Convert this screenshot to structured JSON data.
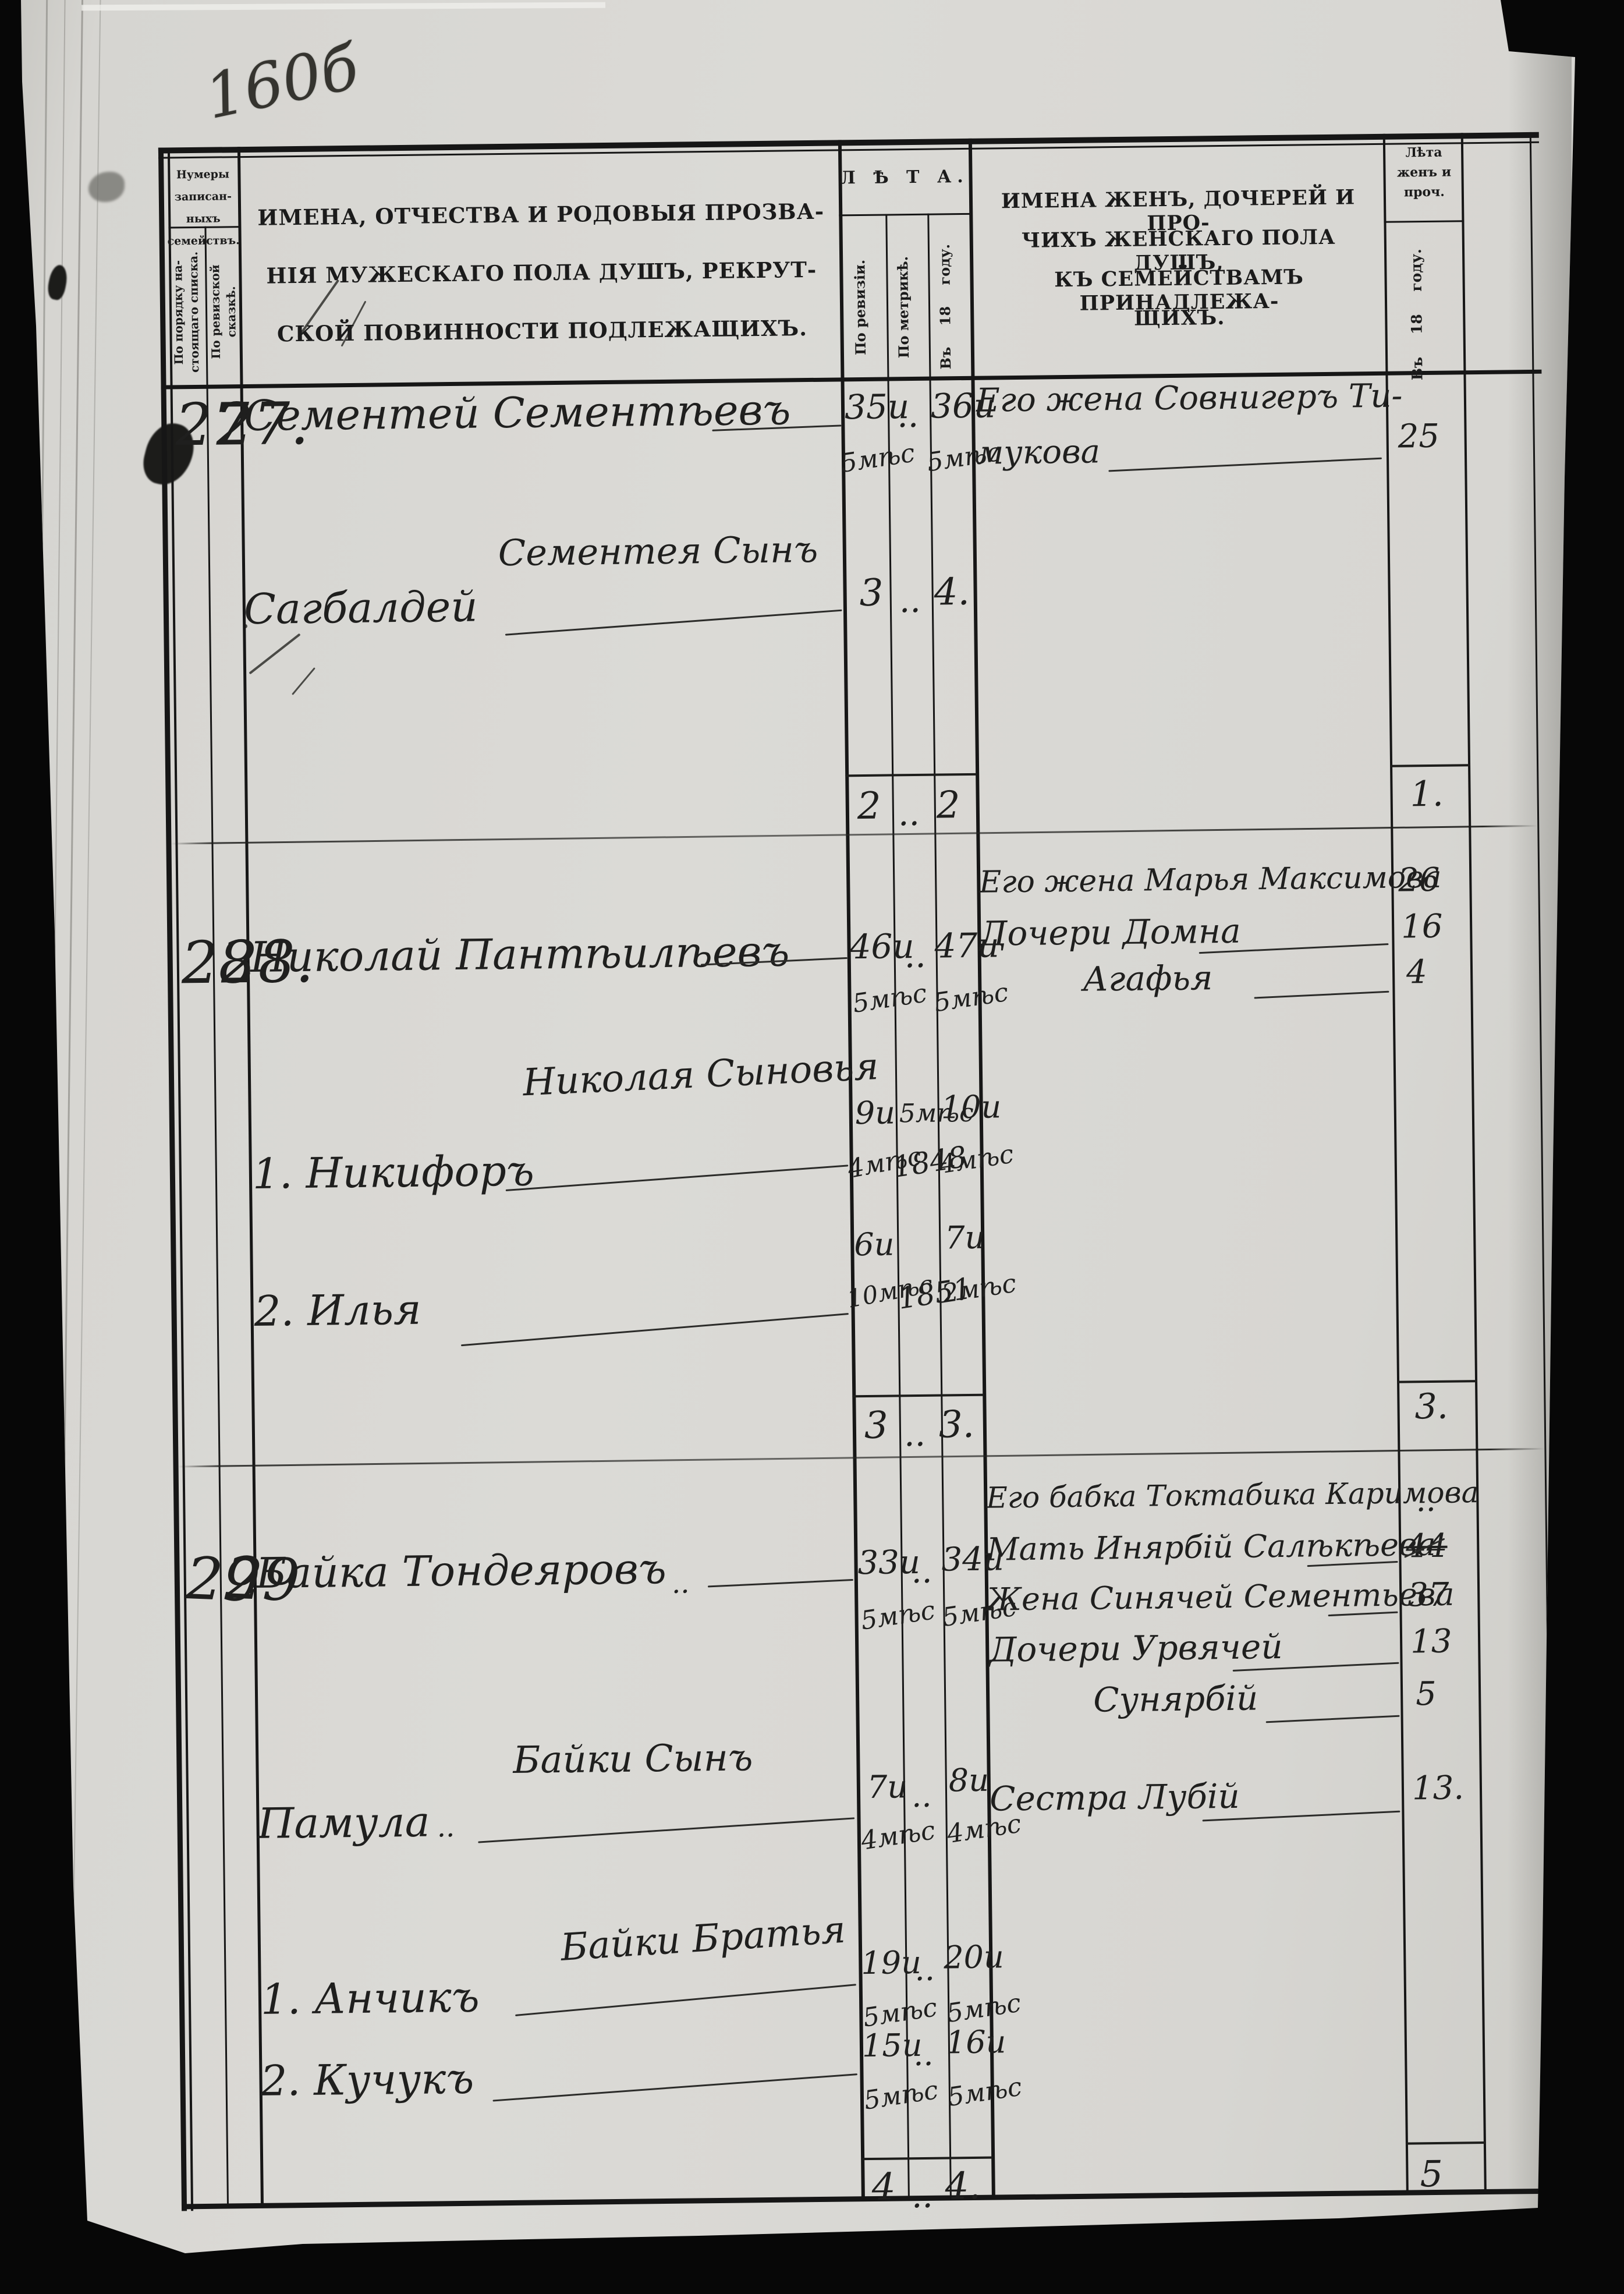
{
  "page": {
    "folio": "160б"
  },
  "header": {
    "families_group": [
      "Нумеры записан-",
      "ныхъ семействъ."
    ],
    "col_order": "По порядку на- стоящаго списка.",
    "col_revision": "По ревизской сказкѣ.",
    "males_title": [
      "ИМЕНА, ОТЧЕСТВА И РОДОВЫЯ ПРОЗВА-",
      "НІЯ МУЖЕСКАГО ПОЛА ДУШЪ, РЕКРУТ-",
      "СКОЙ ПОВИННОСТИ ПОДЛЕЖАЩИХЪ."
    ],
    "leta_title": "Л Ѣ Т А.",
    "col_by_revision": "По ревизіи.",
    "col_by_metrics": "По метрикѣ.",
    "col_in_18": "Въ 18 году.",
    "females_title": [
      "ИМЕНА ЖЕНЪ, ДОЧЕРЕЙ И ПРО-",
      "ЧИХЪ ЖЕНСКАГО ПОЛА ДУШЪ,",
      "КЪ СЕМЕЙСТВАМЪ ПРИНАДЛЕЖА-",
      "ЩИХЪ."
    ],
    "females_age_group": [
      "Лѣта",
      "женъ и",
      "проч."
    ],
    "females_age_col": "Въ 18 году."
  },
  "families": [
    {
      "no": "27",
      "no_rev": "27.",
      "patriarch": "Сементей Сементѣевъ",
      "p_rev": [
        "35и",
        "5мѣс"
      ],
      "p_metr": "..",
      "p_18": [
        "36и",
        "5мѣс"
      ],
      "wife_l1": "Его жена Совнигеръ Ти-",
      "wife_l2": "мукова",
      "wife_age": "25",
      "son_caption": "Сементея Сынъ",
      "son": "Сагбалдей",
      "son_rev": "3",
      "son_metr": "..",
      "son_18": "4.",
      "totals": {
        "rev": "2",
        "metr": "..",
        "y18": "2",
        "women": "1."
      }
    },
    {
      "no": "28",
      "no_rev": "28.",
      "patriarch": "Николай Пантѣилѣевъ",
      "p_rev": [
        "46и",
        "5мѣс"
      ],
      "p_metr": "..",
      "p_18": [
        "47и",
        "5мѣс"
      ],
      "wife": "Его жена Марья Максимова",
      "wife_age": "26",
      "daughter1": "Дочери Домна",
      "daughter1_age": "16",
      "daughter2": "Агафья",
      "daughter2_age": "4",
      "sons_caption": "Николая Сыновья",
      "son1": "1. Никифоръ",
      "son1_rev": [
        "9и",
        "4мѣс"
      ],
      "son1_metr": [
        "5мѣс",
        "1848"
      ],
      "son1_18": [
        "10и",
        "4мѣс"
      ],
      "son2": "2. Илья",
      "son2_rev": [
        "6и",
        "10мѣс"
      ],
      "son2_metr": [
        "",
        "1851"
      ],
      "son2_18": [
        "7и",
        "2мѣс"
      ],
      "totals": {
        "rev": "3",
        "metr": "..",
        "y18": "3.",
        "women": "3."
      }
    },
    {
      "no": "29",
      "no_rev": "29",
      "patriarch": "Байка Тондеяровъ",
      "p_note": "..",
      "p_rev": [
        "33и",
        "5мѣс"
      ],
      "p_metr": "..",
      "p_18": [
        "34и",
        "5мѣс"
      ],
      "grandmother": "Его бабка Токтабика Каримова",
      "grandmother_age": "..",
      "mother": "Мать Инярбій Салѣкѣева",
      "mother_age": "44",
      "wife": "Жена Синячей Сементьева",
      "wife_age": "37",
      "daughter1": "Дочери Урвячей",
      "daughter1_age": "13",
      "daughter2": "Сунярбій",
      "daughter2_age": "5",
      "sister": "Сестра Лубій",
      "sister_age": "13.",
      "son_caption": "Байки Сынъ",
      "son": "Памула",
      "son_note": "..",
      "son_rev": [
        "7и",
        "4мѣс"
      ],
      "son_metr": "..",
      "son_18": [
        "8и",
        "4мѣс"
      ],
      "bros_caption": "Байки Братья",
      "bro1": "1. Анчикъ",
      "bro1_rev": [
        "19и",
        "5мѣс"
      ],
      "bro1_metr": "..",
      "bro1_18": [
        "20и",
        "5мѣс"
      ],
      "bro2": "2. Кучукъ",
      "bro2_rev": [
        "15и",
        "5мѣс"
      ],
      "bro2_metr": "..",
      "bro2_18": [
        "16и",
        "5мѣс"
      ],
      "totals": {
        "rev": "4",
        "metr": "..",
        "y18": "4.",
        "women": "5"
      }
    }
  ]
}
